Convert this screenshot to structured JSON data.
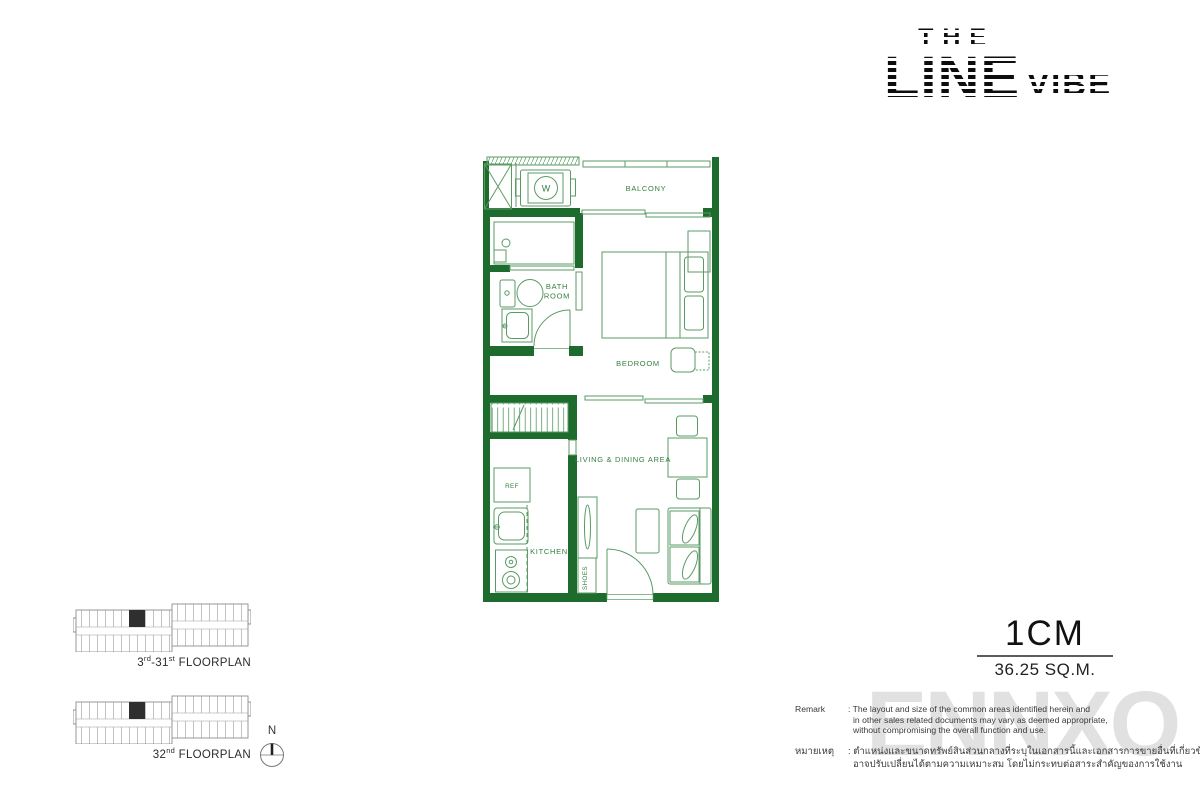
{
  "logo": {
    "the": "THE",
    "line": "LINE",
    "vibe": "VIBE"
  },
  "plan": {
    "rooms": {
      "balcony": "BALCONY",
      "bathroom_line1": "BATH",
      "bathroom_line2": "ROOM",
      "bedroom": "BEDROOM",
      "living": "LIVING & DINING AREA",
      "kitchen": "KITCHEN",
      "shoes": "SHOES",
      "ref": "REF",
      "washer": "W"
    },
    "colors": {
      "wall_green": "#1e6b2e",
      "line_green": "#5a9b64",
      "label_green": "#35803f"
    }
  },
  "unit": {
    "type": "1CM",
    "area": "36.25 SQ.M."
  },
  "keyplans": [
    {
      "num": "3",
      "sup1": "rd",
      "mid": "-31",
      "sup2": "st",
      "rest": " FLOORPLAN"
    },
    {
      "num": "32",
      "sup1": "nd",
      "mid": "",
      "sup2": "",
      "rest": " FLOORPLAN"
    }
  ],
  "compass": {
    "label": "N"
  },
  "remark": {
    "label": "Remark",
    "lines": [
      ": The layout and size of the common areas identified herein and",
      "in other sales related documents may vary as deemed appropriate,",
      "without compromising the overall function and use."
    ],
    "thai_label": "หมายเหตุ",
    "thai_lines": [
      ": ตำแหน่งและขนาดทรัพย์สินส่วนกลางที่ระบุในเอกสารนี้และเอกสารการขายอื่นที่เกี่ยวข้อง",
      "อาจปรับเปลี่ยนได้ตามความเหมาะสม โดยไม่กระทบต่อสาระสำคัญของการใช้งาน"
    ]
  },
  "watermark": "ENNXO"
}
